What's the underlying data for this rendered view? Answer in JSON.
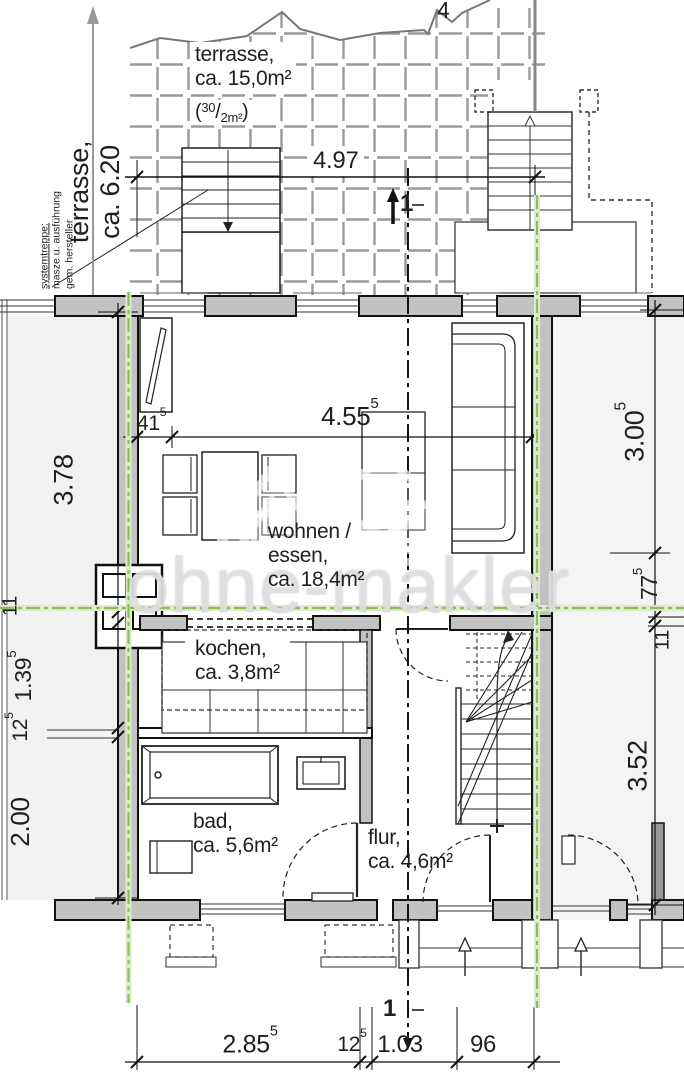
{
  "watermark": {
    "text": "ohne-makler"
  },
  "annotations": {
    "break_label": "4",
    "section_marker_top": "1",
    "section_marker_bottom": "1",
    "stair_note_line1": "systemtreppe:",
    "stair_note_line2": "masze u. ausführung",
    "stair_note_line3": "gem. hersteller",
    "terrace_side_line1": "terrasse,",
    "terrace_side_line2": "ca. 6.20"
  },
  "rooms": {
    "terrasse_name": "terrasse,",
    "terrasse_area": "ca. 15,0m²",
    "terrasse_fraction_open": "(",
    "terrasse_fraction_top": "30",
    "terrasse_fraction_slash": "/",
    "terrasse_fraction_bottom": "2m²",
    "terrasse_fraction_close": ")",
    "wohnen_name": "wohnen /",
    "wohnen_name2": "essen,",
    "wohnen_area": "ca. 18,4m²",
    "kochen_name": "kochen,",
    "kochen_area": "ca. 3,8m²",
    "bad_name": "bad,",
    "bad_area": "ca. 5,6m²",
    "flur_name": "flur,",
    "flur_area": "ca. 4,6m²"
  },
  "dims": {
    "terrace_width": {
      "v": "4.97",
      "s": ""
    },
    "niche": {
      "v": "41",
      "s": "5"
    },
    "living_width": {
      "v": "4.55",
      "s": "5"
    },
    "left_1": {
      "v": "3.78",
      "s": ""
    },
    "left_2": {
      "v": "11",
      "s": ""
    },
    "left_3": {
      "v": "1.39",
      "s": "5"
    },
    "left_4": {
      "v": "12",
      "s": "5"
    },
    "left_5": {
      "v": "2.00",
      "s": ""
    },
    "right_1": {
      "v": "3.00",
      "s": "5"
    },
    "right_2": {
      "v": "77",
      "s": "5"
    },
    "right_3": {
      "v": "11",
      "s": ""
    },
    "right_4": {
      "v": "3.52",
      "s": ""
    },
    "bottom_1": {
      "v": "2.85",
      "s": "5"
    },
    "bottom_2": {
      "v": "12",
      "s": "5"
    },
    "bottom_3": {
      "v": "1.03",
      "s": ""
    },
    "bottom_4": {
      "v": "96",
      "s": ""
    }
  },
  "colors": {
    "axis_green": "#8cbe58",
    "wall_gray": "#c2c2c2",
    "tile_gray": "#999999"
  }
}
